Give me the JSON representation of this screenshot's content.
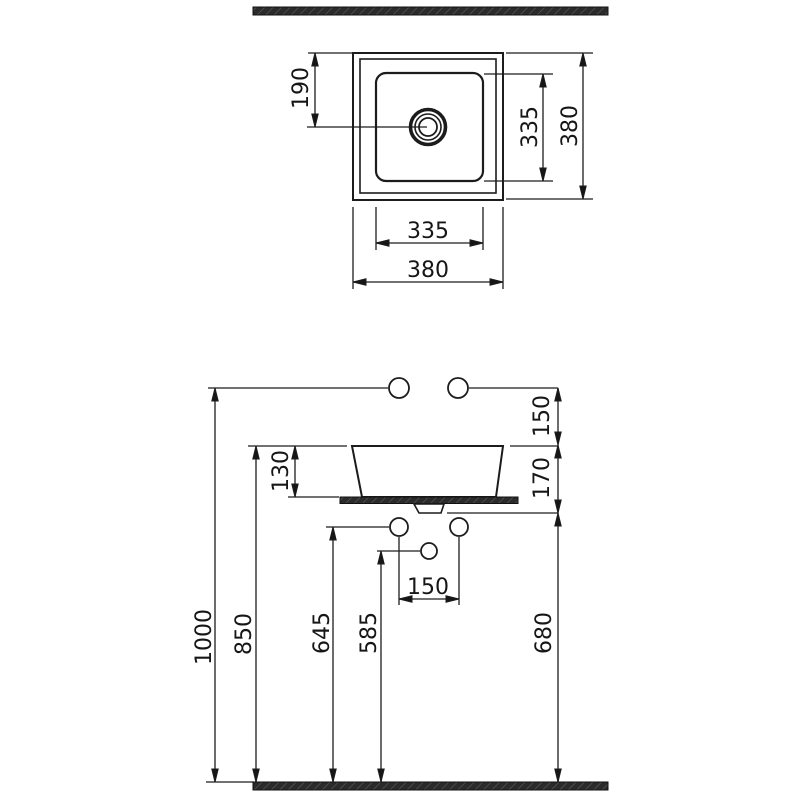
{
  "drawing": {
    "line_color": "#1c1c1c",
    "hatch_fill": "#2b2b2b",
    "top_view": {
      "drain_offset_from_top": "190",
      "inner_height": "335",
      "overall_height": "380",
      "inner_width": "335",
      "overall_width": "380"
    },
    "side_view": {
      "faucet_hole_above_rim": "150",
      "basin_height": "130",
      "rim_to_counter_bottom": "170",
      "overall_height": "1000",
      "rim_height": "850",
      "mount_hole_height": "645",
      "drain_outlet_height": "585",
      "counter_bottom_height": "680",
      "mount_hole_spacing": "150"
    }
  }
}
